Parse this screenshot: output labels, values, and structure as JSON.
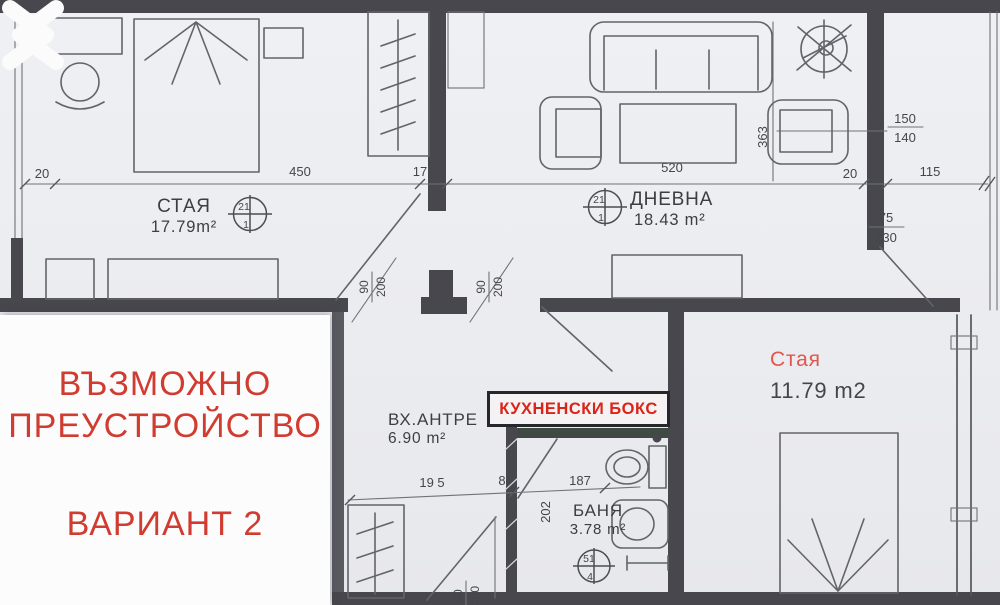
{
  "colors": {
    "paper": "#ecedf1",
    "wall": "#47474d",
    "line": "#55565e",
    "overlay_red": "#d13c31",
    "kitchen_red": "#dc2318",
    "room_red": "#e2564d",
    "text_dark": "#3d3e44"
  },
  "icons": {
    "prev": "chevron-left-icon",
    "next": "chevron-right-icon",
    "crossed_fixture": "crossed-circle-icon"
  },
  "rooms": {
    "staya1": {
      "name": "СТАЯ",
      "area": "17.79m²"
    },
    "dnevna": {
      "name": "ДНЕВНА",
      "area": "18.43 m²"
    },
    "antre": {
      "name": "ВХ.АНТРЕ",
      "area": "6.90 m²"
    },
    "kitchen": {
      "name": "КУХНЕНСКИ БОКС"
    },
    "banya": {
      "name": "БАНЯ",
      "area": "3.78 m²"
    },
    "staya2": {
      "name": "Стая",
      "area": "11.79 m2"
    }
  },
  "overlay": {
    "line1": "ВЪЗМОЖНО",
    "line2": "ПРЕУСТРОЙСТВО",
    "line3": "ВАРИАНТ 2"
  },
  "dims": {
    "left20": "20",
    "w450": "450",
    "w17": "17",
    "w520": "520",
    "right20": "20",
    "w115": "115",
    "w363": "363",
    "win150": "150",
    "win140": "140",
    "door75": "75",
    "door230": "230",
    "door90a": "90",
    "door200a": "200",
    "door90b": "90",
    "door200b": "200",
    "door90c": "90",
    "door200c": "200",
    "w195": "19 5",
    "w8": "8",
    "w187": "187",
    "w202": "202"
  },
  "markers": {
    "staya1": {
      "top": "21",
      "bottom": "1"
    },
    "dnevna": {
      "top": "21",
      "bottom": "1"
    },
    "banya": {
      "top": "51",
      "bottom": "4"
    }
  }
}
